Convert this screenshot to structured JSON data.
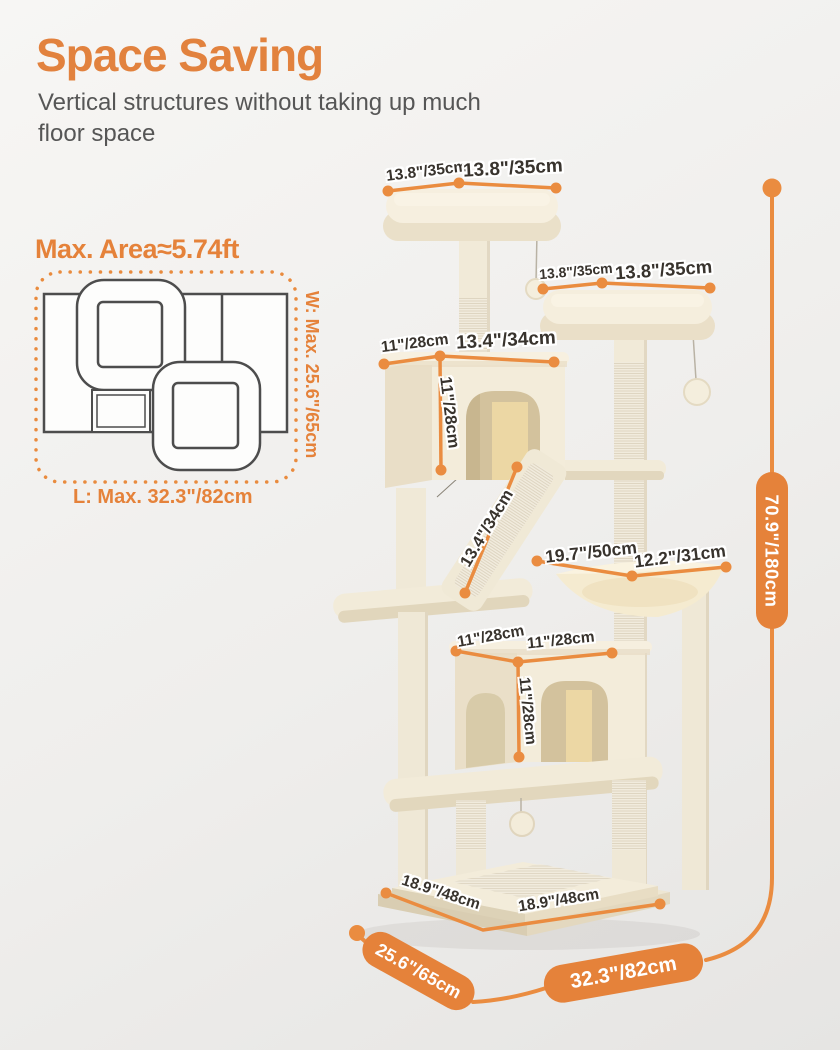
{
  "header": {
    "title": "Space Saving",
    "subtitle": "Vertical structures without taking up much floor space"
  },
  "floorplan": {
    "title": "Max. Area≈5.74ft",
    "width_label": "W: Max. 25.6\"/65cm",
    "length_label": "L: Max. 32.3\"/82cm"
  },
  "tree": {
    "top_perch_depth": "13.8\"/35cm",
    "top_perch_width": "13.8\"/35cm",
    "right_perch_depth": "13.8\"/35cm",
    "right_perch_width": "13.8\"/35cm",
    "upper_condo_depth": "11\"/28cm",
    "upper_condo_width": "13.4\"/34cm",
    "upper_condo_height": "11\"/28cm",
    "ramp_length": "13.4\"/34cm",
    "hammock_width": "19.7\"/50cm",
    "hammock_depth": "12.2\"/31cm",
    "lower_condo_depth": "11\"/28cm",
    "lower_condo_width": "11\"/28cm",
    "lower_condo_height": "11\"/28cm",
    "base_depth": "18.9\"/48cm",
    "base_width": "18.9\"/48cm"
  },
  "overall": {
    "height": "70.9\"/180cm",
    "depth": "25.6\"/65cm",
    "width": "32.3\"/82cm"
  },
  "colors": {
    "accent_orange": "#e5823a",
    "dimension_line": "#ea8c40",
    "label_text": "#38332d",
    "tree_cream": "#f3ecda"
  }
}
